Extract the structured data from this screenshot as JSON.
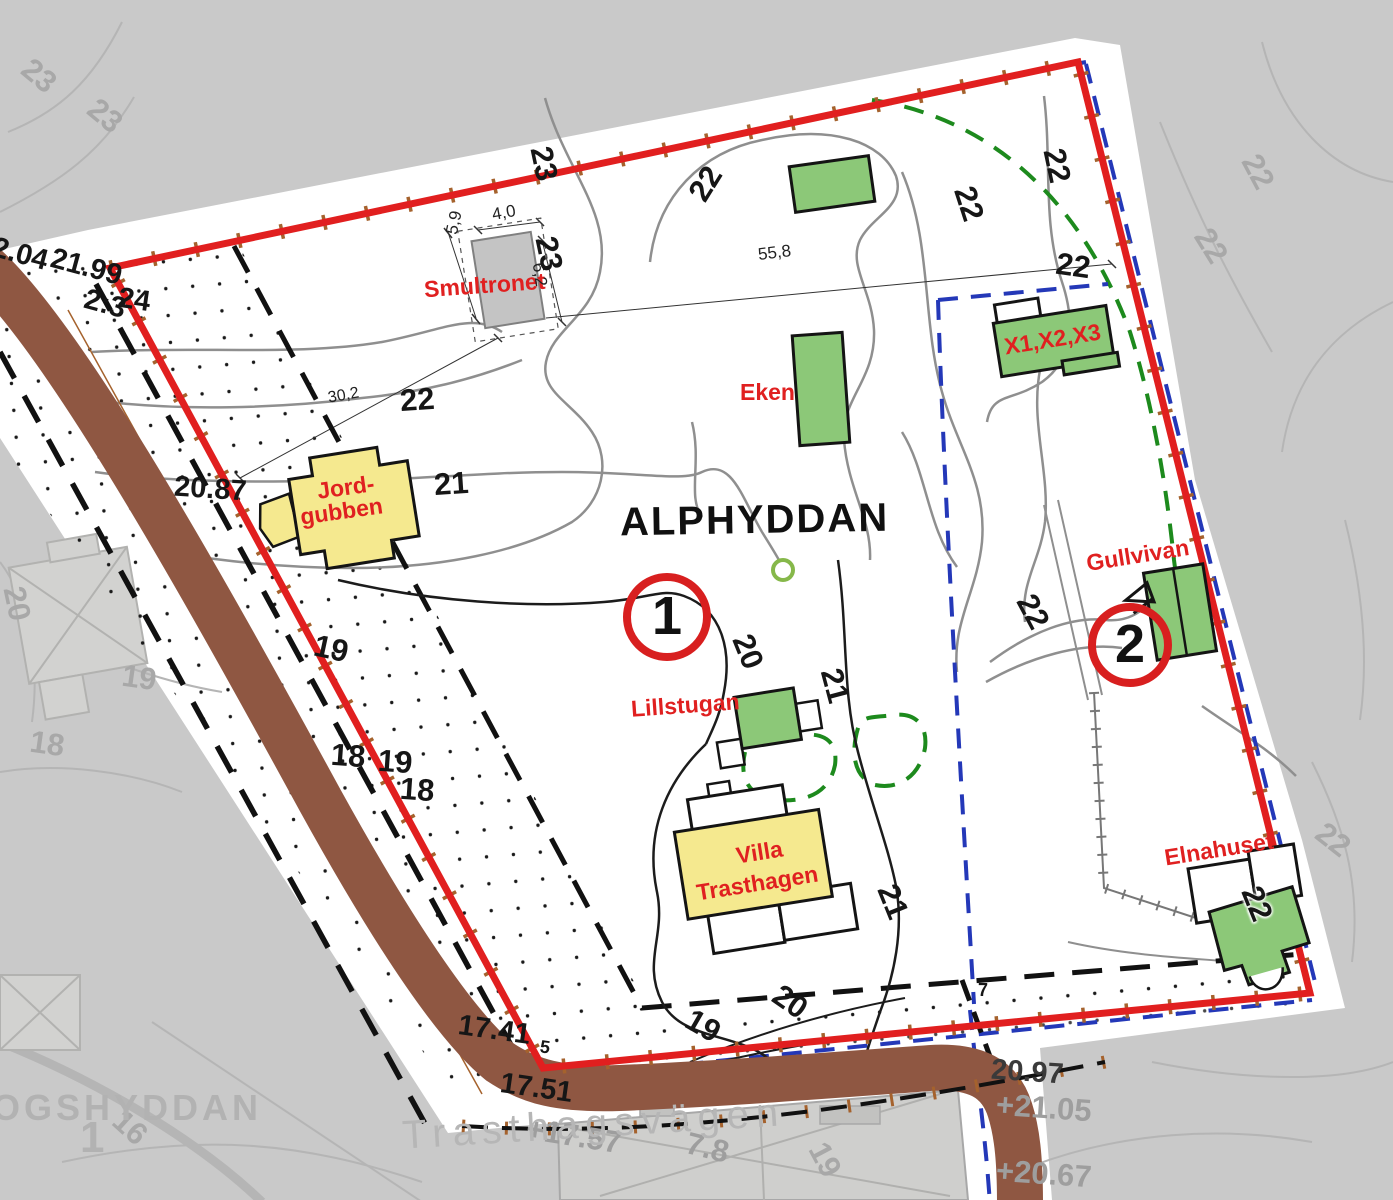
{
  "map": {
    "title": "ALPHYDDAN",
    "area_markers": [
      "1",
      "2"
    ],
    "buildings": {
      "smultronet": "Smultronet",
      "eken": "Eken",
      "x123": "X1,X2,X3",
      "jordgubben_line1": "Jord-",
      "jordgubben_line2": "gubben",
      "lillstugan": "Lillstugan",
      "villa_line1": "Villa",
      "villa_line2": "Trasthagen",
      "gullvivan": "Gullvivan",
      "elnahuset": "Elnahuset"
    },
    "dimensions": {
      "smultronet_left": "5,9",
      "smultronet_top": "4,0",
      "smultronet_right": "6,2",
      "line_left": "30,2",
      "line_right": "55,8"
    },
    "spot_heights_black": [
      "22.04",
      "21.99",
      "2:3",
      "24",
      "20.87",
      "17.41",
      "5",
      "17.51",
      "7",
      "20.97"
    ],
    "spot_heights_gray": [
      "+21.05",
      "+20.67",
      "+17.57",
      "7.8"
    ],
    "contour_labels_inside": [
      "23",
      "23",
      "22",
      "22",
      "22",
      "22",
      "22",
      "21",
      "20",
      "21",
      "22",
      "21",
      "20",
      "19",
      "19",
      "18",
      "19",
      "18",
      "22"
    ],
    "contour_labels_outside": [
      "23",
      "23",
      "22",
      "22",
      "22",
      "20",
      "19",
      "18",
      "16",
      "19"
    ],
    "context": {
      "neighbor_property": "OGSHYDDAN",
      "neighbor_number": "1",
      "road_name": "Trasthagsvägen"
    },
    "colors": {
      "boundary_red": "#e11f1f",
      "building_green": "#8cc878",
      "building_yellow": "#f5e98f",
      "existing_building_gray": "#c4c4c4",
      "road_brown": "#8f5742",
      "tick_brown": "#a5622d",
      "dashed_blue": "#2438b8",
      "dashed_green": "#1d8a1d",
      "label_red": "#e02020"
    }
  }
}
